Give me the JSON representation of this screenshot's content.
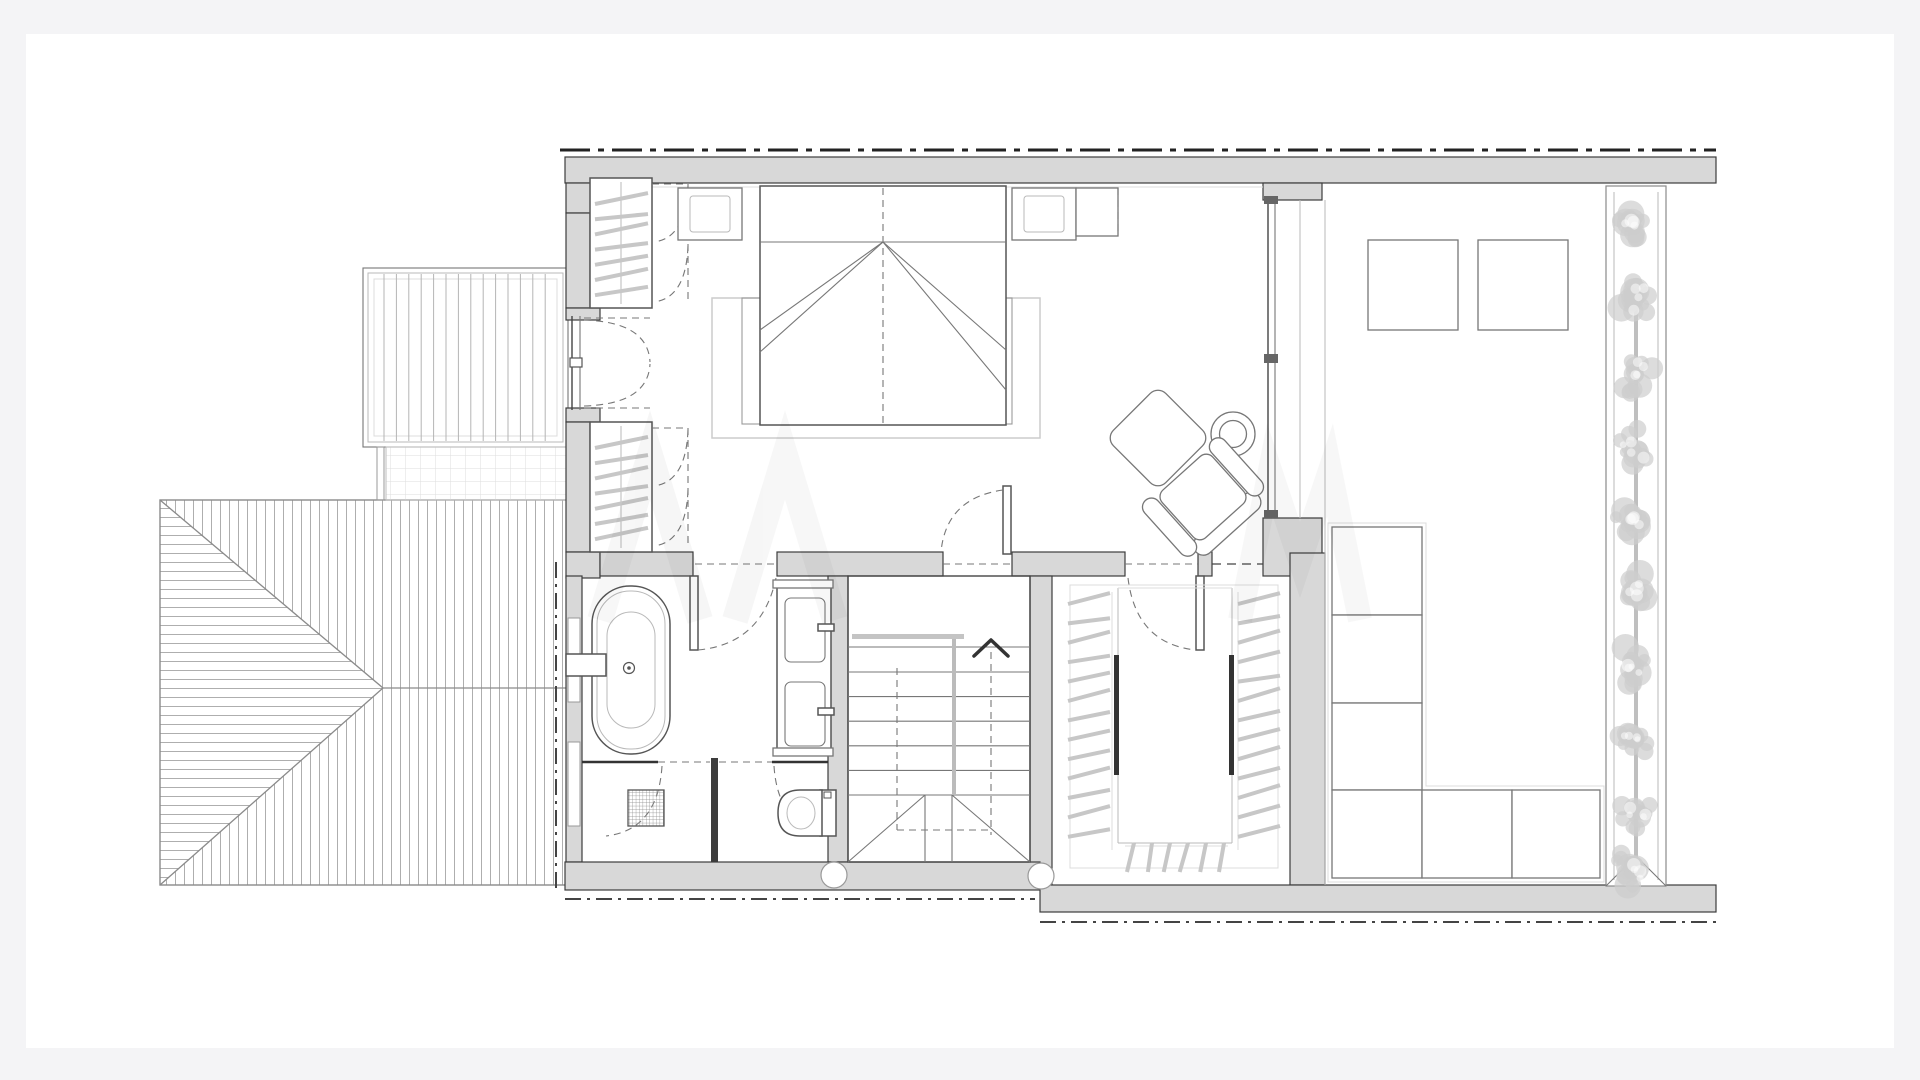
{
  "document": {
    "kind": "architectural-floor-plan-upper-floor",
    "visible_text": [],
    "watermark_visible": true
  },
  "colors": {
    "canvas_bg": "#f4f4f6",
    "page": "#ffffff",
    "wall": "#d8d8d8",
    "wall_edge": "#3c3c3c",
    "line_dark": "#444444",
    "line_mid": "#777777",
    "line_light": "#b9b9b9",
    "line_faint": "#dcdcdc",
    "hanger": "#c7c7c7",
    "rail": "#bfbfbf",
    "foliage": "#cdcdcd",
    "boundary": "#222222",
    "fixture": "#555555"
  },
  "rooms": [
    {
      "id": "bedroom",
      "contents": [
        "double-bed",
        "headboard",
        "area-rug",
        "nightstand-left",
        "nightstand-right",
        "table-lamp-left",
        "table-lamp-right",
        "low-cabinet",
        "built-in-wardrobe-top",
        "built-in-wardrobe-bottom",
        "french-balcony-door",
        "glass-slider-to-terrace",
        "armchair",
        "ottoman",
        "round-side-table"
      ]
    },
    {
      "id": "bathroom",
      "contents": [
        "freestanding-bathtub",
        "wall-faucet",
        "double-vanity",
        "walk-in-shower",
        "floor-drain",
        "toilet",
        "glass-partition"
      ]
    },
    {
      "id": "stair-hall",
      "contents": [
        "staircase-up",
        "handrail",
        "winder-treads",
        "walk-line-arrow"
      ]
    },
    {
      "id": "walk-in-closet",
      "contents": [
        "hanging-rails",
        "clothes-hangers",
        "wardrobe-rods"
      ]
    },
    {
      "id": "roof-terrace",
      "contents": [
        "square-table-1",
        "square-table-2",
        "modular-corner-sofa",
        "planter-hedge-with-trees"
      ]
    },
    {
      "id": "exterior",
      "contents": [
        "louvered-pergola-deck",
        "tiled-landing",
        "hipped-roof-hatched",
        "site-boundary-dash-dot"
      ]
    }
  ],
  "counts": {
    "wardrobes": 2,
    "wardrobe_hangers_each": 7,
    "stair_tread_lines": 6,
    "closet_hangers_left": 13,
    "closet_hangers_right": 13,
    "closet_hangers_bottom": 6,
    "terrace_tables": 2,
    "sofa_modules": 6,
    "tree_canopies": 10,
    "pergola_slats": 14,
    "bath_basins": 2
  },
  "terrace": {
    "tree_y": [
      222,
      298,
      372,
      448,
      520,
      594,
      666,
      740,
      814,
      866
    ]
  },
  "stairs": {
    "direction_arrow": "up"
  }
}
